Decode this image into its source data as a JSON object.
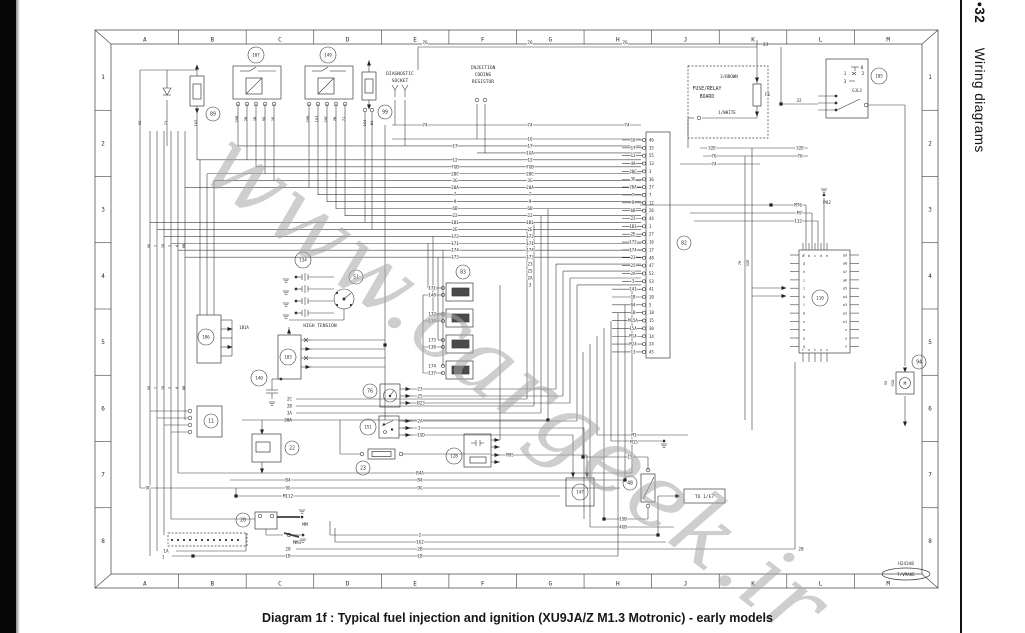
{
  "caption": "Diagram 1f : Typical fuel injection and ignition (XU9JA/Z M1.3 Motronic) - early models",
  "sidebar": {
    "page_number": "•32",
    "section_title": "Wiring diagrams"
  },
  "watermark": "www.cargeek.ir",
  "stamp": {
    "code": "H24348",
    "oval": "T/VMAKE"
  },
  "grid": {
    "columns": [
      "A",
      "B",
      "C",
      "D",
      "E",
      "F",
      "G",
      "H",
      "J",
      "K",
      "L",
      "M"
    ],
    "rows": [
      "1",
      "2",
      "3",
      "4",
      "5",
      "6",
      "7",
      "8"
    ]
  },
  "bus": {
    "mid_labels": [
      "16",
      "17",
      "1GA",
      "12",
      "7GB",
      "20C",
      "3G",
      "20A",
      "7",
      "9",
      "6B",
      "22",
      "1B1",
      "2E",
      "172",
      "171",
      "174",
      "173",
      "23",
      "25",
      "2A",
      "3"
    ],
    "left_indexes": [
      1,
      3,
      4,
      5,
      6,
      7,
      8,
      9,
      10,
      11,
      12,
      13,
      14,
      15,
      16,
      17
    ]
  },
  "ecu": {
    "rows": [
      [
        "16",
        "46"
      ],
      [
        "17",
        "35"
      ],
      [
        "12",
        "55"
      ],
      [
        "4A",
        "13"
      ],
      [
        "20C",
        "3"
      ],
      [
        "3G",
        "36"
      ],
      [
        "20A",
        "37"
      ],
      [
        "7",
        "7"
      ],
      [
        "9",
        "12"
      ],
      [
        "6B",
        "26"
      ],
      [
        "22",
        "44"
      ],
      [
        "1B1",
        "1"
      ],
      [
        "2E",
        "27"
      ],
      [
        "172",
        "16"
      ],
      [
        "174",
        "17"
      ],
      [
        "23",
        "48"
      ],
      [
        "25",
        "47"
      ],
      [
        "2A",
        "52"
      ],
      [
        "3",
        "53"
      ],
      [
        "141",
        "41"
      ],
      [
        "1B",
        "10"
      ],
      [
        "B4",
        "5"
      ],
      [
        "1B",
        "18"
      ],
      [
        "M15A",
        "15"
      ],
      [
        "15A",
        "30"
      ],
      [
        "M14",
        "14"
      ],
      [
        "M24",
        "24"
      ],
      [
        "13",
        "45"
      ]
    ]
  },
  "injectors": [
    [
      "171",
      "140"
    ],
    [
      "172",
      "139"
    ],
    [
      "173",
      "138"
    ],
    [
      "174",
      "137"
    ]
  ],
  "module110": {
    "top": [
      "a",
      "b",
      "c",
      "d",
      "e"
    ],
    "left": [
      "f",
      "g",
      "h",
      "i",
      "j",
      "k",
      "l",
      "m",
      "n",
      "o",
      "p",
      "q"
    ],
    "right": [
      "a9",
      "a8",
      "a7",
      "a6",
      "a5",
      "a4",
      "a3",
      "a2",
      "a1",
      "z",
      "y",
      "x"
    ],
    "bottom": [
      "r",
      "s",
      "t",
      "u",
      "v"
    ]
  },
  "components": [
    {
      "id": "89",
      "x": 213,
      "y": 114
    },
    {
      "id": "99",
      "x": 385,
      "y": 112
    },
    {
      "id": "107",
      "x": 256,
      "y": 55
    },
    {
      "id": "149",
      "x": 328,
      "y": 55
    },
    {
      "id": "105",
      "x": 879,
      "y": 76
    },
    {
      "id": "134",
      "x": 303,
      "y": 260
    },
    {
      "id": "51",
      "x": 356,
      "y": 277
    },
    {
      "id": "103",
      "x": 288,
      "y": 357
    },
    {
      "id": "140",
      "x": 259,
      "y": 378
    },
    {
      "id": "106",
      "x": 206,
      "y": 337
    },
    {
      "id": "11",
      "x": 211,
      "y": 421
    },
    {
      "id": "22",
      "x": 292,
      "y": 448
    },
    {
      "id": "23",
      "x": 363,
      "y": 468
    },
    {
      "id": "20",
      "x": 243,
      "y": 520
    },
    {
      "id": "76",
      "x": 370,
      "y": 391
    },
    {
      "id": "151",
      "x": 368,
      "y": 427
    },
    {
      "id": "128",
      "x": 454,
      "y": 456
    },
    {
      "id": "83",
      "x": 463,
      "y": 272
    },
    {
      "id": "82",
      "x": 684,
      "y": 243
    },
    {
      "id": "110",
      "x": 820,
      "y": 298
    },
    {
      "id": "147",
      "x": 580,
      "y": 492
    },
    {
      "id": "48",
      "x": 630,
      "y": 483
    },
    {
      "id": "94",
      "x": 919,
      "y": 362
    }
  ],
  "diagram_labels": [
    {
      "t": "76",
      "x": 425,
      "y": 44,
      "h": 1
    },
    {
      "t": "76",
      "x": 530,
      "y": 44,
      "h": 1
    },
    {
      "t": "76",
      "x": 625,
      "y": 44,
      "h": 1
    },
    {
      "t": "2J",
      "x": 763,
      "y": 46,
      "a": "s"
    },
    {
      "t": "74",
      "x": 425,
      "y": 126.5,
      "h": 1
    },
    {
      "t": "74",
      "x": 530,
      "y": 126.5,
      "h": 1
    },
    {
      "t": "74",
      "x": 627,
      "y": 126.5,
      "h": 1
    },
    {
      "t": "74",
      "x": 714,
      "y": 165.5,
      "h": 1
    },
    {
      "t": "32E",
      "x": 712,
      "y": 149.5,
      "h": 1
    },
    {
      "t": "32E",
      "x": 800,
      "y": 149.5,
      "h": 1
    },
    {
      "t": "76",
      "x": 714,
      "y": 157.5,
      "h": 1
    },
    {
      "t": "76",
      "x": 800,
      "y": 157.5,
      "h": 1
    },
    {
      "t": "32",
      "x": 799,
      "y": 102,
      "h": 1
    },
    {
      "n": "diagnostic-socket-label",
      "t": "DIAGNOSTIC",
      "x": 400,
      "y": 75,
      "s": 4.6
    },
    {
      "t": "SOCKET",
      "x": 400,
      "y": 82,
      "s": 4.6
    },
    {
      "n": "injection-coding-resistor-label",
      "t": "INJECTION",
      "x": 483,
      "y": 69,
      "s": 4.6
    },
    {
      "t": "CODING",
      "x": 483,
      "y": 76,
      "s": 4.6
    },
    {
      "t": "RESISTOR",
      "x": 483,
      "y": 83,
      "s": 4.6
    },
    {
      "n": "fuse-relay-board-label",
      "t": "FUSE/RELAY",
      "x": 707,
      "y": 90,
      "s": 4.8
    },
    {
      "t": "BOARD",
      "x": 707,
      "y": 98,
      "s": 4.8
    },
    {
      "t": "3/BROWN",
      "x": 729,
      "y": 78,
      "s": 4.2
    },
    {
      "t": "1/WHITE",
      "x": 727,
      "y": 114,
      "s": 4.2
    },
    {
      "t": "FS",
      "x": 765,
      "y": 96,
      "s": 4.2,
      "a": "s"
    },
    {
      "t": "0",
      "x": 862,
      "y": 69,
      "s": 4.4
    },
    {
      "t": "1",
      "x": 845,
      "y": 75,
      "s": 4.4
    },
    {
      "t": "2",
      "x": 863,
      "y": 75,
      "s": 4.4
    },
    {
      "t": "3",
      "x": 845,
      "y": 83,
      "s": 4.4
    },
    {
      "t": "GJL3",
      "x": 857,
      "y": 92,
      "s": 4
    },
    {
      "t": "PH2",
      "x": 827,
      "y": 204,
      "s": 4.4
    },
    {
      "t": "M76",
      "x": 802,
      "y": 206.5,
      "a": "e",
      "h": 1
    },
    {
      "t": "M7",
      "x": 802,
      "y": 214.5,
      "a": "e",
      "h": 1
    },
    {
      "t": "112",
      "x": 802,
      "y": 222.5,
      "a": "e",
      "h": 1
    },
    {
      "n": "high-tension-label",
      "t": "HIGH TENSION",
      "x": 320,
      "y": 327,
      "s": 4.6
    },
    {
      "t": "1B1A",
      "x": 244,
      "y": 329,
      "s": 4,
      "h": 1
    },
    {
      "t": "2C",
      "x": 292,
      "y": 400.5,
      "a": "e"
    },
    {
      "t": "2B",
      "x": 292,
      "y": 407.5,
      "a": "e"
    },
    {
      "t": "3A",
      "x": 292,
      "y": 414.5,
      "a": "e"
    },
    {
      "t": "20A",
      "x": 292,
      "y": 421.5,
      "a": "e"
    },
    {
      "t": "23",
      "x": 420,
      "y": 390.5,
      "h": 1
    },
    {
      "t": "25",
      "x": 420,
      "y": 397.5,
      "h": 1
    },
    {
      "t": "B23",
      "x": 421,
      "y": 404.5,
      "h": 1
    },
    {
      "t": "2A",
      "x": 420,
      "y": 422.5,
      "h": 1
    },
    {
      "t": "3",
      "x": 419,
      "y": 429.5,
      "h": 1
    },
    {
      "t": "1SD",
      "x": 421,
      "y": 436.5,
      "h": 1
    },
    {
      "t": "M9S",
      "x": 510,
      "y": 456.5,
      "h": 1
    },
    {
      "t": "B4A",
      "x": 420,
      "y": 474.5,
      "h": 1
    },
    {
      "t": "B4",
      "x": 420,
      "y": 481.5,
      "h": 1
    },
    {
      "t": "9G",
      "x": 420,
      "y": 489.5,
      "h": 1
    },
    {
      "t": "B4",
      "x": 288,
      "y": 481.5,
      "h": 1
    },
    {
      "t": "9G",
      "x": 288,
      "y": 489.5,
      "h": 1
    },
    {
      "t": "M112",
      "x": 288,
      "y": 497.5,
      "h": 1
    },
    {
      "t": "9G",
      "x": 148,
      "y": 489.5,
      "h": 1
    },
    {
      "t": "M1",
      "x": 634,
      "y": 436.5,
      "h": 1
    },
    {
      "t": "M15",
      "x": 634,
      "y": 443.5,
      "h": 1
    },
    {
      "t": "13",
      "x": 630,
      "y": 458.5,
      "h": 1
    },
    {
      "t": "1SB",
      "x": 623,
      "y": 520.5,
      "h": 1
    },
    {
      "t": "4GB",
      "x": 623,
      "y": 528.5,
      "h": 1
    },
    {
      "t": "2",
      "x": 420,
      "y": 536.5,
      "h": 1
    },
    {
      "t": "1G2",
      "x": 420,
      "y": 543.5,
      "h": 1
    },
    {
      "t": "2B",
      "x": 420,
      "y": 550.5,
      "h": 1
    },
    {
      "t": "1B",
      "x": 420,
      "y": 557.5,
      "h": 1
    },
    {
      "t": "20",
      "x": 288,
      "y": 550.5,
      "h": 1
    },
    {
      "t": "1B",
      "x": 288,
      "y": 557.5,
      "h": 1
    },
    {
      "t": "1A",
      "x": 166,
      "y": 552.5,
      "h": 1
    },
    {
      "t": "1",
      "x": 163,
      "y": 558.5,
      "h": 1
    },
    {
      "t": "20",
      "x": 801,
      "y": 550.5,
      "h": 1
    },
    {
      "t": "MM",
      "x": 305,
      "y": 526,
      "s": 4.6
    },
    {
      "t": "MM3",
      "x": 297,
      "y": 544,
      "s": 4.6
    },
    {
      "n": "to-1e7-ref",
      "t": "TO 1/E7",
      "x": 704.5,
      "y": 498,
      "s": 4.6
    },
    {
      "t": "92",
      "x": 887,
      "y": 383,
      "r": -90,
      "s": 3.8
    },
    {
      "t": "92A",
      "x": 894,
      "y": 383,
      "r": -90,
      "s": 3.8
    },
    {
      "t": "76",
      "x": 741,
      "y": 263,
      "r": -90,
      "s": 3.8
    },
    {
      "t": "32E",
      "x": 749,
      "y": 263,
      "r": -90,
      "s": 3.8
    },
    {
      "t": "M",
      "x": 905,
      "y": 385,
      "s": 4.4
    },
    {
      "t": "20B",
      "x": 238,
      "y": 119,
      "r": -90,
      "s": 3.8
    },
    {
      "t": "2B",
      "x": 247,
      "y": 119,
      "r": -90,
      "s": 3.8
    },
    {
      "t": "1B",
      "x": 256,
      "y": 119,
      "r": -90,
      "s": 3.8
    },
    {
      "t": "9G",
      "x": 265,
      "y": 119,
      "r": -90,
      "s": 3.8
    },
    {
      "t": "1G",
      "x": 274,
      "y": 119,
      "r": -90,
      "s": 3.8
    },
    {
      "t": "20B",
      "x": 309,
      "y": 119,
      "r": -90,
      "s": 3.8
    },
    {
      "t": "1G3",
      "x": 318,
      "y": 119,
      "r": -90,
      "s": 3.8
    },
    {
      "t": "20C",
      "x": 327,
      "y": 119,
      "r": -90,
      "s": 3.8
    },
    {
      "t": "2B",
      "x": 336,
      "y": 119,
      "r": -90,
      "s": 3.8
    },
    {
      "t": "71",
      "x": 345,
      "y": 119,
      "r": -90,
      "s": 3.8
    },
    {
      "t": "1G4",
      "x": 366,
      "y": 123,
      "r": -90,
      "s": 3.8
    },
    {
      "t": "B4",
      "x": 373,
      "y": 123,
      "r": -90,
      "s": 3.8
    },
    {
      "t": "1G2",
      "x": 197,
      "y": 123,
      "r": -90,
      "s": 3.8
    },
    {
      "t": "71",
      "x": 167,
      "y": 123,
      "r": -90,
      "s": 3.8
    },
    {
      "t": "9G",
      "x": 141,
      "y": 123,
      "r": -90,
      "s": 3.8
    },
    {
      "t": "9G",
      "x": 150,
      "y": 246,
      "r": -90,
      "s": 3.8
    },
    {
      "t": "7",
      "x": 157,
      "y": 246,
      "r": -90,
      "s": 3.8
    },
    {
      "t": "1G",
      "x": 164,
      "y": 246,
      "r": -90,
      "s": 3.8
    },
    {
      "t": "2",
      "x": 171,
      "y": 246,
      "r": -90,
      "s": 3.8
    },
    {
      "t": "4",
      "x": 178,
      "y": 246,
      "r": -90,
      "s": 3.8
    },
    {
      "t": "8B",
      "x": 185,
      "y": 246,
      "r": -90,
      "s": 3.8
    },
    {
      "t": "9G",
      "x": 150,
      "y": 388,
      "r": -90,
      "s": 3.8
    },
    {
      "t": "7",
      "x": 157,
      "y": 388,
      "r": -90,
      "s": 3.8
    },
    {
      "t": "1G",
      "x": 164,
      "y": 388,
      "r": -90,
      "s": 3.8
    },
    {
      "t": "2",
      "x": 171,
      "y": 388,
      "r": -90,
      "s": 3.8
    },
    {
      "t": "4",
      "x": 178,
      "y": 388,
      "r": -90,
      "s": 3.8
    },
    {
      "t": "8B",
      "x": 185,
      "y": 388,
      "r": -90,
      "s": 3.8
    }
  ]
}
